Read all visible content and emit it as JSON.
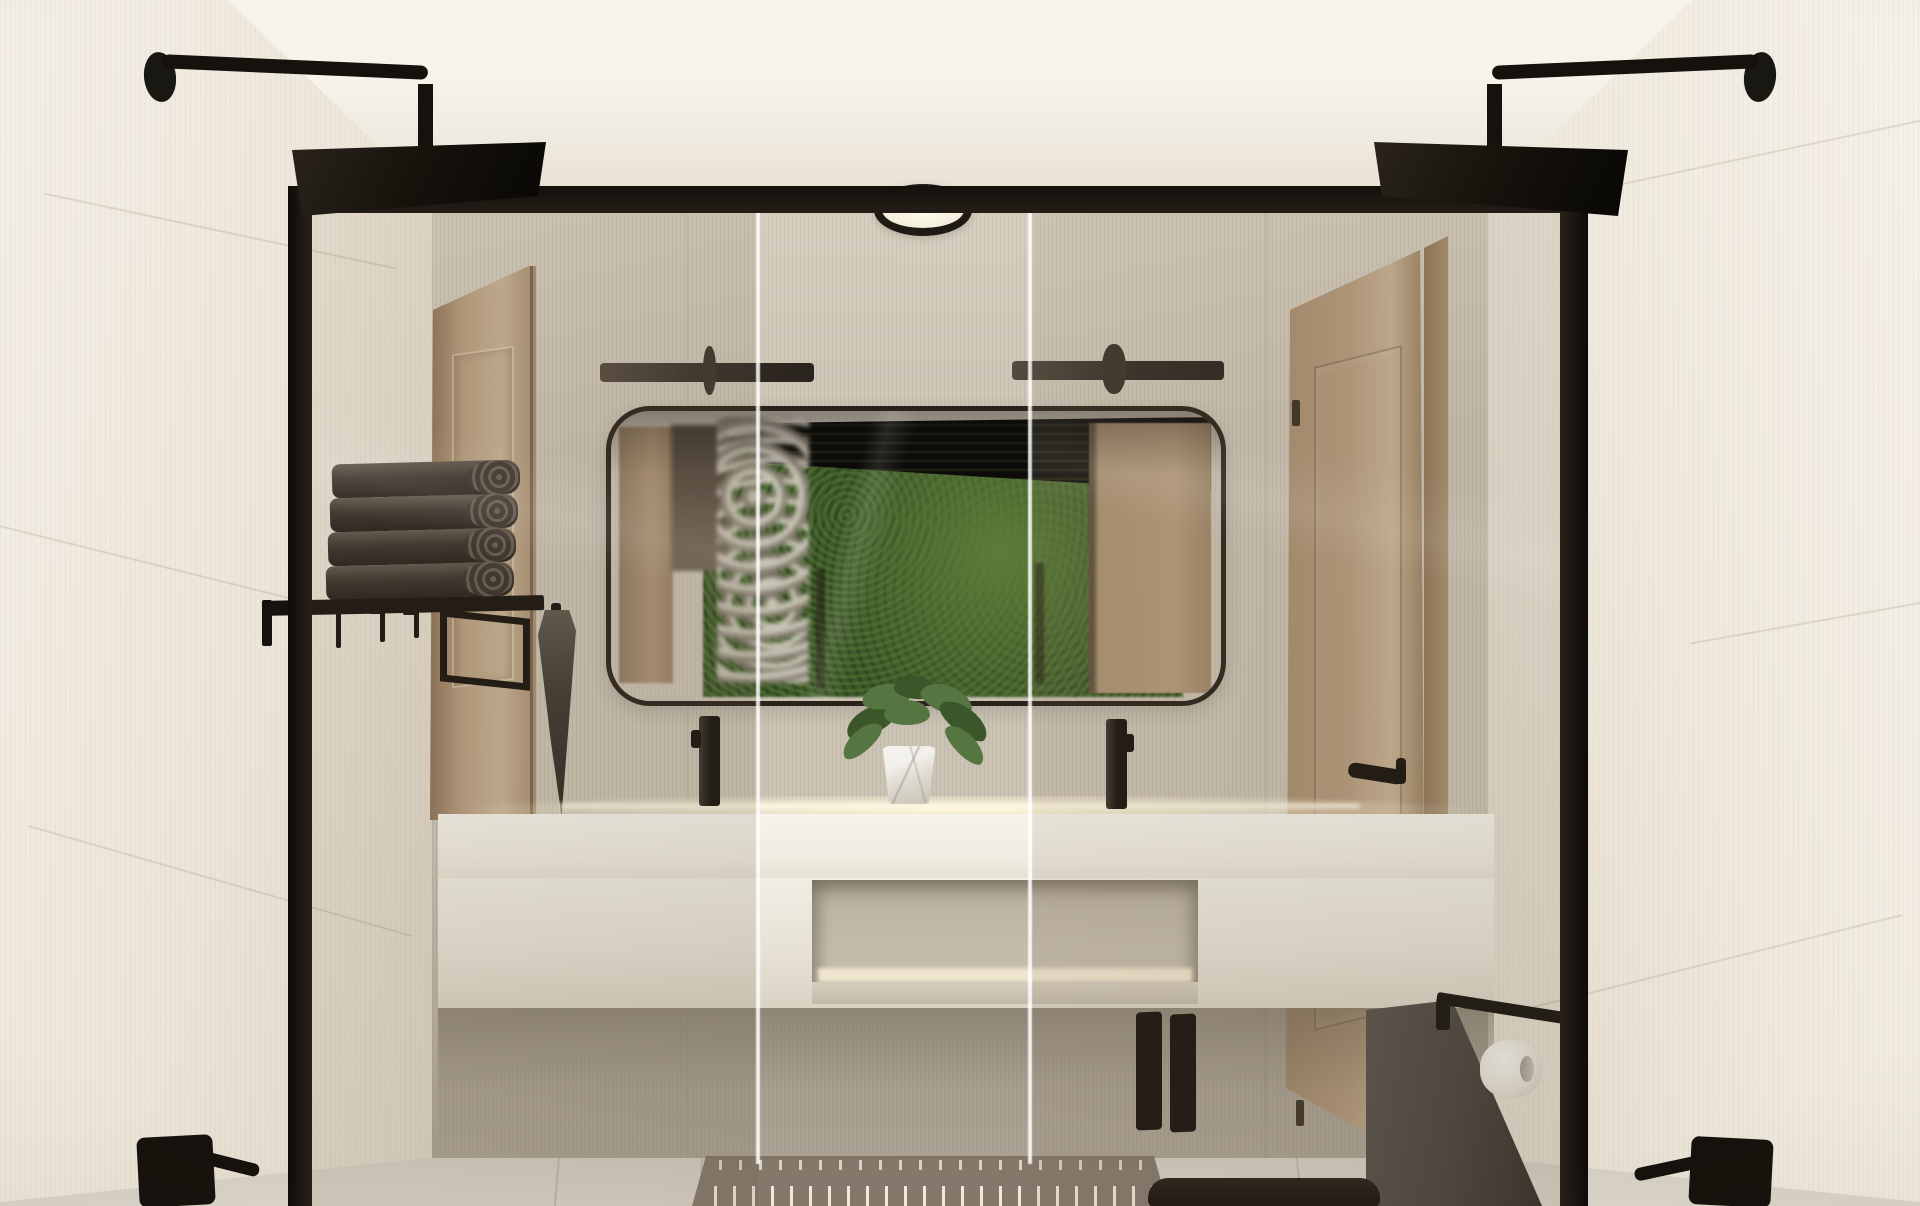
{
  "scene": {
    "type": "3d-interior-render",
    "room": "bathroom",
    "view": "one-point perspective from walk-in double shower toward vanity wall",
    "features": [
      "matte-black fixtures",
      "framed glass shower screens",
      "floating vanity with LED strip",
      "moss wall visible in mirror reflection"
    ]
  },
  "palette": {
    "ceiling-top": "#f7f3eb",
    "ceiling-bottom": "#e7e0d3",
    "wall-left-near": "#f4efe7",
    "wall-left-far": "#ddd4c5",
    "wall-right-near": "#f6f1e9",
    "wall-right-far": "#e0d8c9",
    "back-wall": "#cbc3b4",
    "back-wall-light": "#d7cfc0",
    "back-wall-dark": "#aba294",
    "floor-near": "#dbd5c9",
    "floor-far": "#c9c3b6",
    "grout": "#b3ac9f",
    "fixture-black": "#15110c",
    "fixture-dark": "#332c24",
    "wood": "#b69c7e",
    "wood-dark": "#8c7256",
    "wood-light": "#c7b193",
    "mirror-frame": "#29221b",
    "mirror-wall": "#cbc2b3",
    "moss": "#3c5727",
    "moss-dark": "#25381a",
    "moss-light": "#5c7d39",
    "refl-wood": "#ab9273",
    "refl-dark": "#4b4137",
    "refl-pale": "#d3ccc0",
    "towel": "#39312a",
    "towel-light": "#5e554b",
    "counter": "#f6f3ea",
    "counter-shade": "#e6e1d3",
    "led-glow": "#fff5d9",
    "niche": "#c4bbab",
    "niche-glow": "#efe6cd",
    "niche-lip": "#d6cdbc",
    "under-shadow": "rgba(92,82,67,0.45)",
    "mat": "rgba(122,110,96,0.9)",
    "mat-rib": "#efe9dc",
    "toilet-gray": "#57514a",
    "toilet-gray-dark": "#312d27",
    "toilet-black": "#16120d",
    "paper": "#f4f1ea",
    "paper-shade": "#c7c2b5",
    "plant": "#567641",
    "plant-dark": "#3b5729",
    "pot": "#f3f1ec",
    "pot-shade": "#c6c2b6",
    "glass-tint": "rgba(135,114,90,0.12)",
    "glass-line": "rgba(255,255,255,0.85)",
    "downlight-ring": "#1f1a14",
    "downlight-glow": "#fffdf0"
  },
  "objects": {
    "rain_shower_heads": {
      "count": 2,
      "finish": "matte-black",
      "shape": "square"
    },
    "shower_glass_panels": {
      "count": 2,
      "frame_finish": "matte-black"
    },
    "shower_valves": {
      "count": 2,
      "finish": "matte-black"
    },
    "ceiling_downlight": {
      "count": 1
    },
    "vanity_mirror": {
      "count": 1,
      "shape": "rounded-rectangle"
    },
    "wall_sconces": {
      "count": 2,
      "finish": "matte-black"
    },
    "vessel_faucets": {
      "count": 2,
      "finish": "matte-black"
    },
    "folded_towels": {
      "count": 4,
      "color": "charcoal"
    },
    "towel_shelf": {
      "count": 1,
      "finish": "matte-black"
    },
    "robe_hooks": {
      "count": 3,
      "finish": "matte-black"
    },
    "hand_towels": {
      "count": 2,
      "color": "charcoal"
    },
    "monstera_plant": {
      "count": 1,
      "pot": "white-marble"
    },
    "floating_vanity": {
      "count": 1,
      "open_niche": true,
      "led_underglow": true
    },
    "doors": {
      "count": 2,
      "material": "light-oak",
      "hardware": "matte-black"
    },
    "wall_hung_toilet": {
      "count": 1,
      "color": "black"
    },
    "flush_buttons": {
      "count": 2,
      "color": "black"
    },
    "toilet_paper_holder": {
      "count": 1,
      "finish": "matte-black",
      "roll_color": "white"
    },
    "bath_mat": {
      "count": 1,
      "color": "taupe"
    },
    "moss_wall": {
      "count": 1,
      "visible_in": "mirror-reflection"
    }
  }
}
